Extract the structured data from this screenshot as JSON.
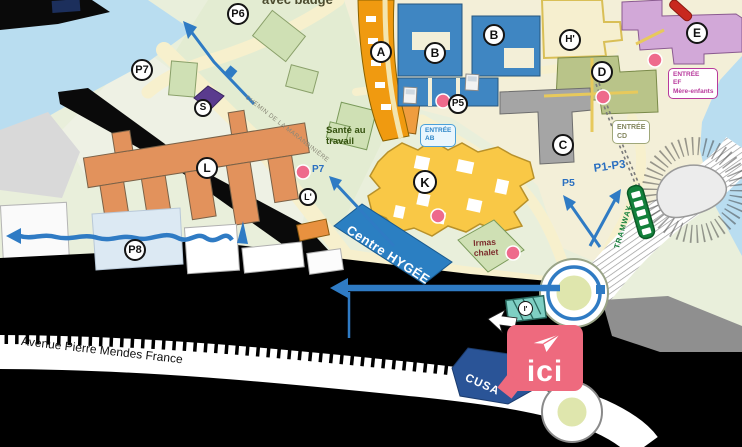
{
  "map_note": {
    "badge": "avec badge"
  },
  "roads": {
    "chemin": "CHEMIN DE LA MARANDINIÈRE",
    "avenue": "Avenue Pierre Mendes France",
    "tramway": "TRAMWAY",
    "tram_symbol": "T"
  },
  "building_labels": {
    "a": "A",
    "b_west": "B",
    "b_east": "B",
    "c": "C",
    "d": "D",
    "e": "E",
    "h_prime": "H'",
    "k": "K",
    "l": "L",
    "l_prime": "L'",
    "s": "S",
    "i_prime": "I'"
  },
  "parking_labels": {
    "p5": "P5",
    "p6": "P6",
    "p7": "P7",
    "p8": "P8"
  },
  "route_labels": {
    "p1_p3": "P1-P3",
    "p5": "P5",
    "p7": "P7"
  },
  "places": {
    "sante_line1": "Santé au",
    "sante_line2": "travail",
    "hygee": "Centre HYGÉE",
    "irmas_line1": "Irmas",
    "irmas_line2": "chalet",
    "cusa": "CUSA"
  },
  "entrances": {
    "ab_line1": "ENTRÉE",
    "ab_line2": "AB",
    "cd_line1": "ENTRÉE",
    "cd_line2": "CD",
    "ef_line1": "ENTRÉE",
    "ef_line2": "EF",
    "ef_line3": "Mère-enfants"
  },
  "marker": {
    "label": "ici"
  },
  "colors": {
    "route_blue": "#2f7bc4",
    "marker_pink": "#ee6a7e",
    "water_blue": "#b9ddf0",
    "building_orange": "#f09a10",
    "complex_orange": "#e2925c",
    "building_blue": "#3f86c2",
    "building_yellow": "#f9c846",
    "building_purple": "#5a3b8e",
    "building_mauve": "#d2a8d8",
    "building_green": "#b9c489",
    "building_gray": "#a5a5a5",
    "hygee_blue": "#2b7fc2",
    "cusa_navy": "#2a5497",
    "entrance_dot_pink": "#ee6a8c",
    "tram_green": "#13813b"
  }
}
